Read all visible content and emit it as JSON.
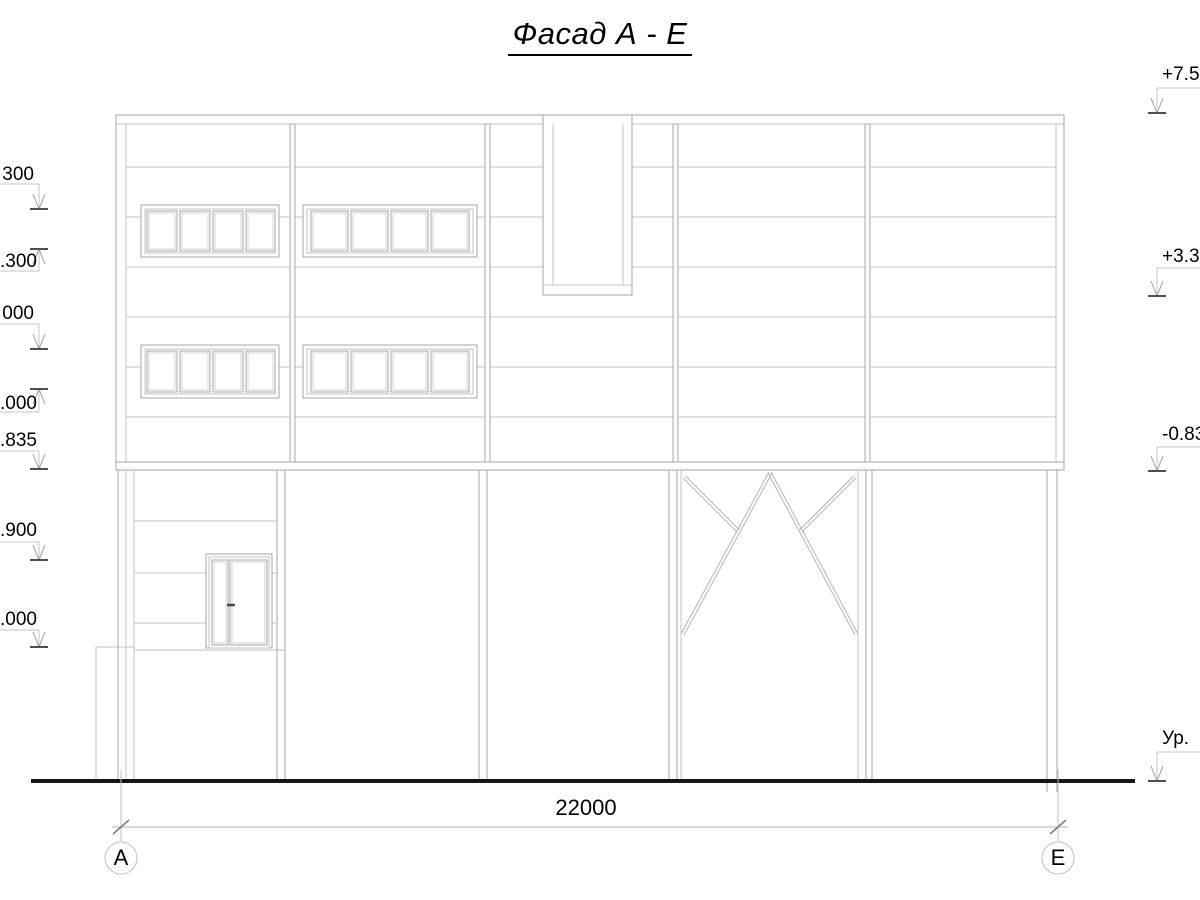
{
  "title": "Фасад А - Е",
  "dimension": {
    "total": "22000"
  },
  "axes": {
    "left": "А",
    "right": "Е"
  },
  "elevation_marks_left": [
    {
      "label": "300"
    },
    {
      "label": ".300"
    },
    {
      "label": "000"
    },
    {
      "label": ".000"
    },
    {
      "label": ".835"
    },
    {
      "label": ".900"
    },
    {
      "label": ".000"
    }
  ],
  "elevation_marks_right": [
    {
      "label": "+7.50"
    },
    {
      "label": "+3.30"
    },
    {
      "label": "-0.83"
    },
    {
      "label": "Ур."
    }
  ],
  "colors": {
    "line_main": "#a6a6a6",
    "line_light": "#c3c3c3",
    "tick_dark": "#4f4f4f",
    "ground": "#161616",
    "text": "#000000"
  }
}
